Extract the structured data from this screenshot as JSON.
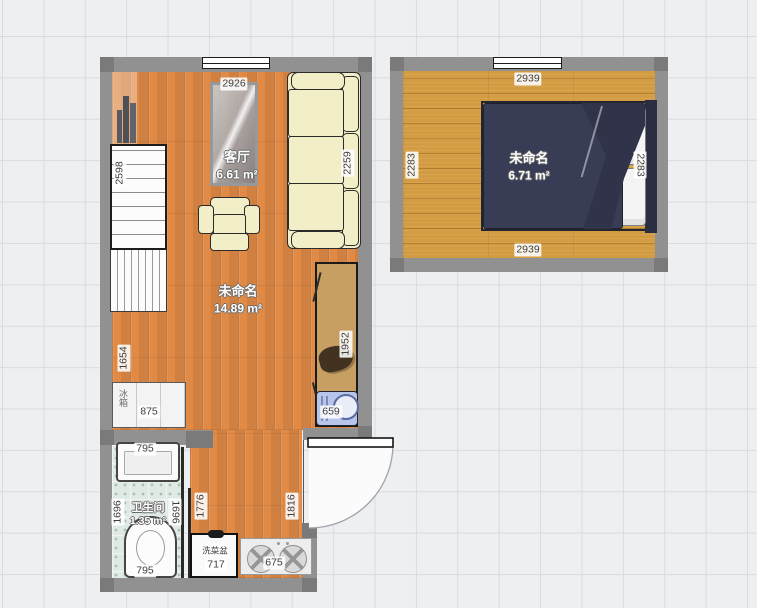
{
  "app": {
    "type": "floor-plan-editor-canvas"
  },
  "colors": {
    "wall": "#919191",
    "wall_corner": "#7a7a7a",
    "wood_main": "#e08a45",
    "wood_bedroom": "#d49c42",
    "bath_tile": "#e0eae4",
    "sofa": "#f2efc8",
    "wardrobe": "#c79f63",
    "washer": "#b7c5ea",
    "bed": "#383c55",
    "outline": "#2b2b2b"
  },
  "rooms": {
    "living": {
      "name": "客厅",
      "area": "6.61 m²"
    },
    "main": {
      "name": "未命名",
      "area": "14.89 m²"
    },
    "bathroom": {
      "name": "卫生间",
      "area": "1.35 m²"
    },
    "bedroom": {
      "name": "未命名",
      "area": "6.71 m²"
    }
  },
  "dimensions": {
    "living_top": "2926",
    "living_left": "2598",
    "sofa": "2259",
    "main_left": "1654",
    "wardrobe": "1952",
    "fridge": "875",
    "washer": "659",
    "bath_sink": "795",
    "bath_left": "1696",
    "bath_right": "1696",
    "toilet": "795",
    "kitchen_left": "1776",
    "kitchen_right": "1816",
    "sink_cabinet": "717",
    "stove": "675",
    "bedroom_top": "2939",
    "bedroom_bottom": "2939",
    "bedroom_left": "2283",
    "bedroom_right": "2283"
  },
  "labels": {
    "fridge": "冰箱",
    "sink_cabinet": "洗菜盆"
  }
}
